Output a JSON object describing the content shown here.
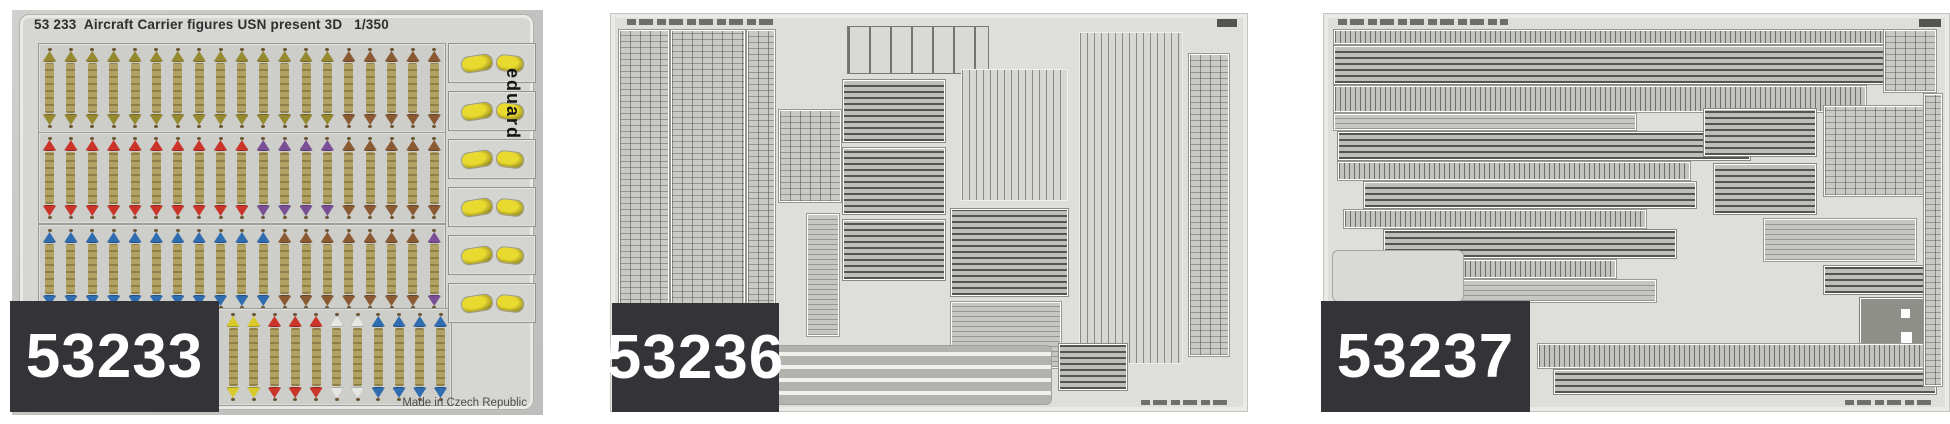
{
  "page": {
    "background": "#ffffff"
  },
  "colors": {
    "badge_bg": "#343438",
    "badge_text": "#ffffff",
    "photo1_bg": "#c3c3c1",
    "pe_sheet_bg": "#dededb"
  },
  "products": [
    {
      "code": "53233",
      "title": "53 233  Aircraft Carrier figures USN present 3D   1/350",
      "brand_vertical": "eduard",
      "made_in": "Made in Czech Republic",
      "figure_colors": {
        "olive": "#97892f",
        "brown": "#8a5a33",
        "red": "#cb3428",
        "purple": "#7a4f95",
        "blue": "#2f6cb0",
        "yellow": "#d8ca2a",
        "white": "#e6e6e2"
      },
      "figure_blocks": [
        {
          "groups": [
            [
              "olive",
              14
            ],
            [
              "brown",
              5
            ]
          ]
        },
        {
          "groups": [
            [
              "red",
              10
            ],
            [
              "purple",
              4
            ],
            [
              "brown",
              5
            ]
          ]
        },
        {
          "groups": [
            [
              "blue",
              11
            ],
            [
              "brown",
              7
            ],
            [
              "purple",
              1
            ]
          ]
        },
        {
          "groups": [
            [
              "yellow",
              4
            ],
            [
              "red",
              3
            ],
            [
              "white",
              2
            ],
            [
              "blue",
              4
            ]
          ]
        }
      ],
      "side_boxes": 6
    },
    {
      "code": "53236"
    },
    {
      "code": "53237"
    }
  ]
}
